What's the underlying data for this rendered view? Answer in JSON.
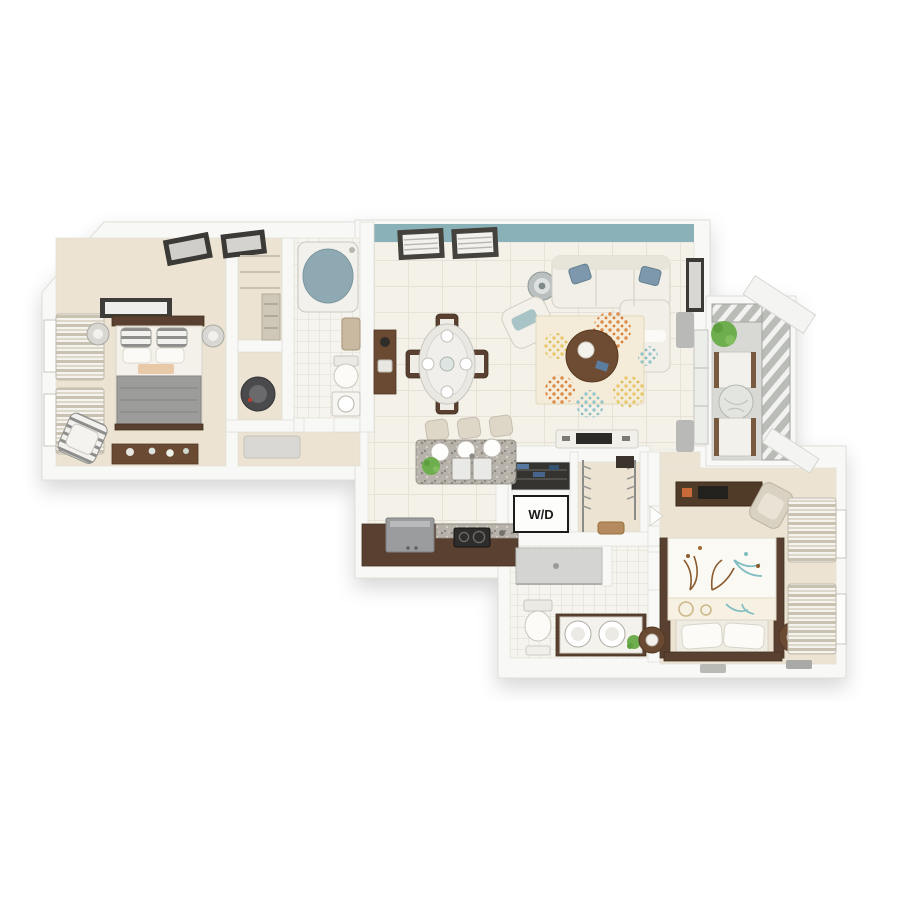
{
  "scene": {
    "description": "3D top-down dollhouse rendering of an apartment floor plan on a white background",
    "unit_summary": "two bedrooms, two bathrooms, open living-dining-kitchen, laundry closet, walk-in closets, balcony"
  },
  "labels": {
    "washer_dryer": "W/D"
  },
  "palette": {
    "background": "#ffffff",
    "wall": "#f8f8f6",
    "wall_edge": "#dfdeD8",
    "floor_wood": "#ece3d2",
    "tile": "#f4f1e9",
    "tile_line": "#e5e1d6",
    "bath_tile": "#f6f4ee",
    "accent_wall": "#8bb1b8",
    "wood_mid": "#6b4a33",
    "wood_dark": "#5a4030",
    "granite_base": "#b7b3aa",
    "sofa_white": "#f1efe8",
    "blanket_gray": "#9c9c9a",
    "rug_base": "#f4ecd9",
    "rug_orange": "#dd8a4a",
    "rug_yellow": "#e7c766",
    "rug_teal": "#96c6cb",
    "pillow_blue": "#7d98ac",
    "tub_water": "#8fa9b3",
    "plant_green": "#6fae4e",
    "balcony_floor": "#d8d9d5",
    "appliance_steel": "#9a9c9e",
    "appliance_dark": "#2e2d2b"
  },
  "rooms": [
    {
      "name": "bedroom-1",
      "furniture": [
        "bed with gray blanket and striped pillows",
        "dark headboard",
        "wall art",
        "nightstand lamps",
        "dresser with jars",
        "striped accent chair",
        "two windows with striped drapes"
      ]
    },
    {
      "name": "walk-in-closet-1",
      "furniture": [
        "shelving",
        "ladder shelf"
      ]
    },
    {
      "name": "utility-closet",
      "furniture": [
        "water heater"
      ]
    },
    {
      "name": "bathroom-1",
      "furniture": [
        "bathtub",
        "toilet",
        "vanity sink",
        "towel"
      ]
    },
    {
      "name": "living-room",
      "furniture": [
        "teal accent wall with two shuttered windows",
        "white sectional sofa with blue pillows",
        "decor urn",
        "white accent chair",
        "round wood coffee table",
        "floral area rug",
        "tv console",
        "framed art",
        "balcony door with drapes"
      ]
    },
    {
      "name": "dining-area",
      "furniture": [
        "oval glass table",
        "four wood chairs",
        "place settings",
        "console table"
      ]
    },
    {
      "name": "kitchen",
      "furniture": [
        "granite island with double sink",
        "three pendant lights",
        "three bar stools",
        "potted plant",
        "refrigerator",
        "cooktop",
        "wood counter run"
      ]
    },
    {
      "name": "laundry-closet",
      "furniture": [
        "linen shelves",
        "stacked washer dryer labeled W/D"
      ]
    },
    {
      "name": "walk-in-closet-2",
      "furniture": [
        "hanging rods with clothes",
        "bench"
      ]
    },
    {
      "name": "bathroom-2",
      "furniture": [
        "walk-in shower",
        "toilet",
        "dark double vanity",
        "plant",
        "towels"
      ]
    },
    {
      "name": "bedroom-2",
      "furniture": [
        "bed with floral duvet",
        "white pillows on pale headboard",
        "round nightstands with lamps",
        "desk with monitor",
        "desk chair",
        "two windows with striped drapes",
        "floor mats"
      ]
    },
    {
      "name": "balcony",
      "furniture": [
        "two patio chairs",
        "round glass table",
        "hanging plant",
        "slatted railing",
        "white overhang beams"
      ]
    }
  ]
}
